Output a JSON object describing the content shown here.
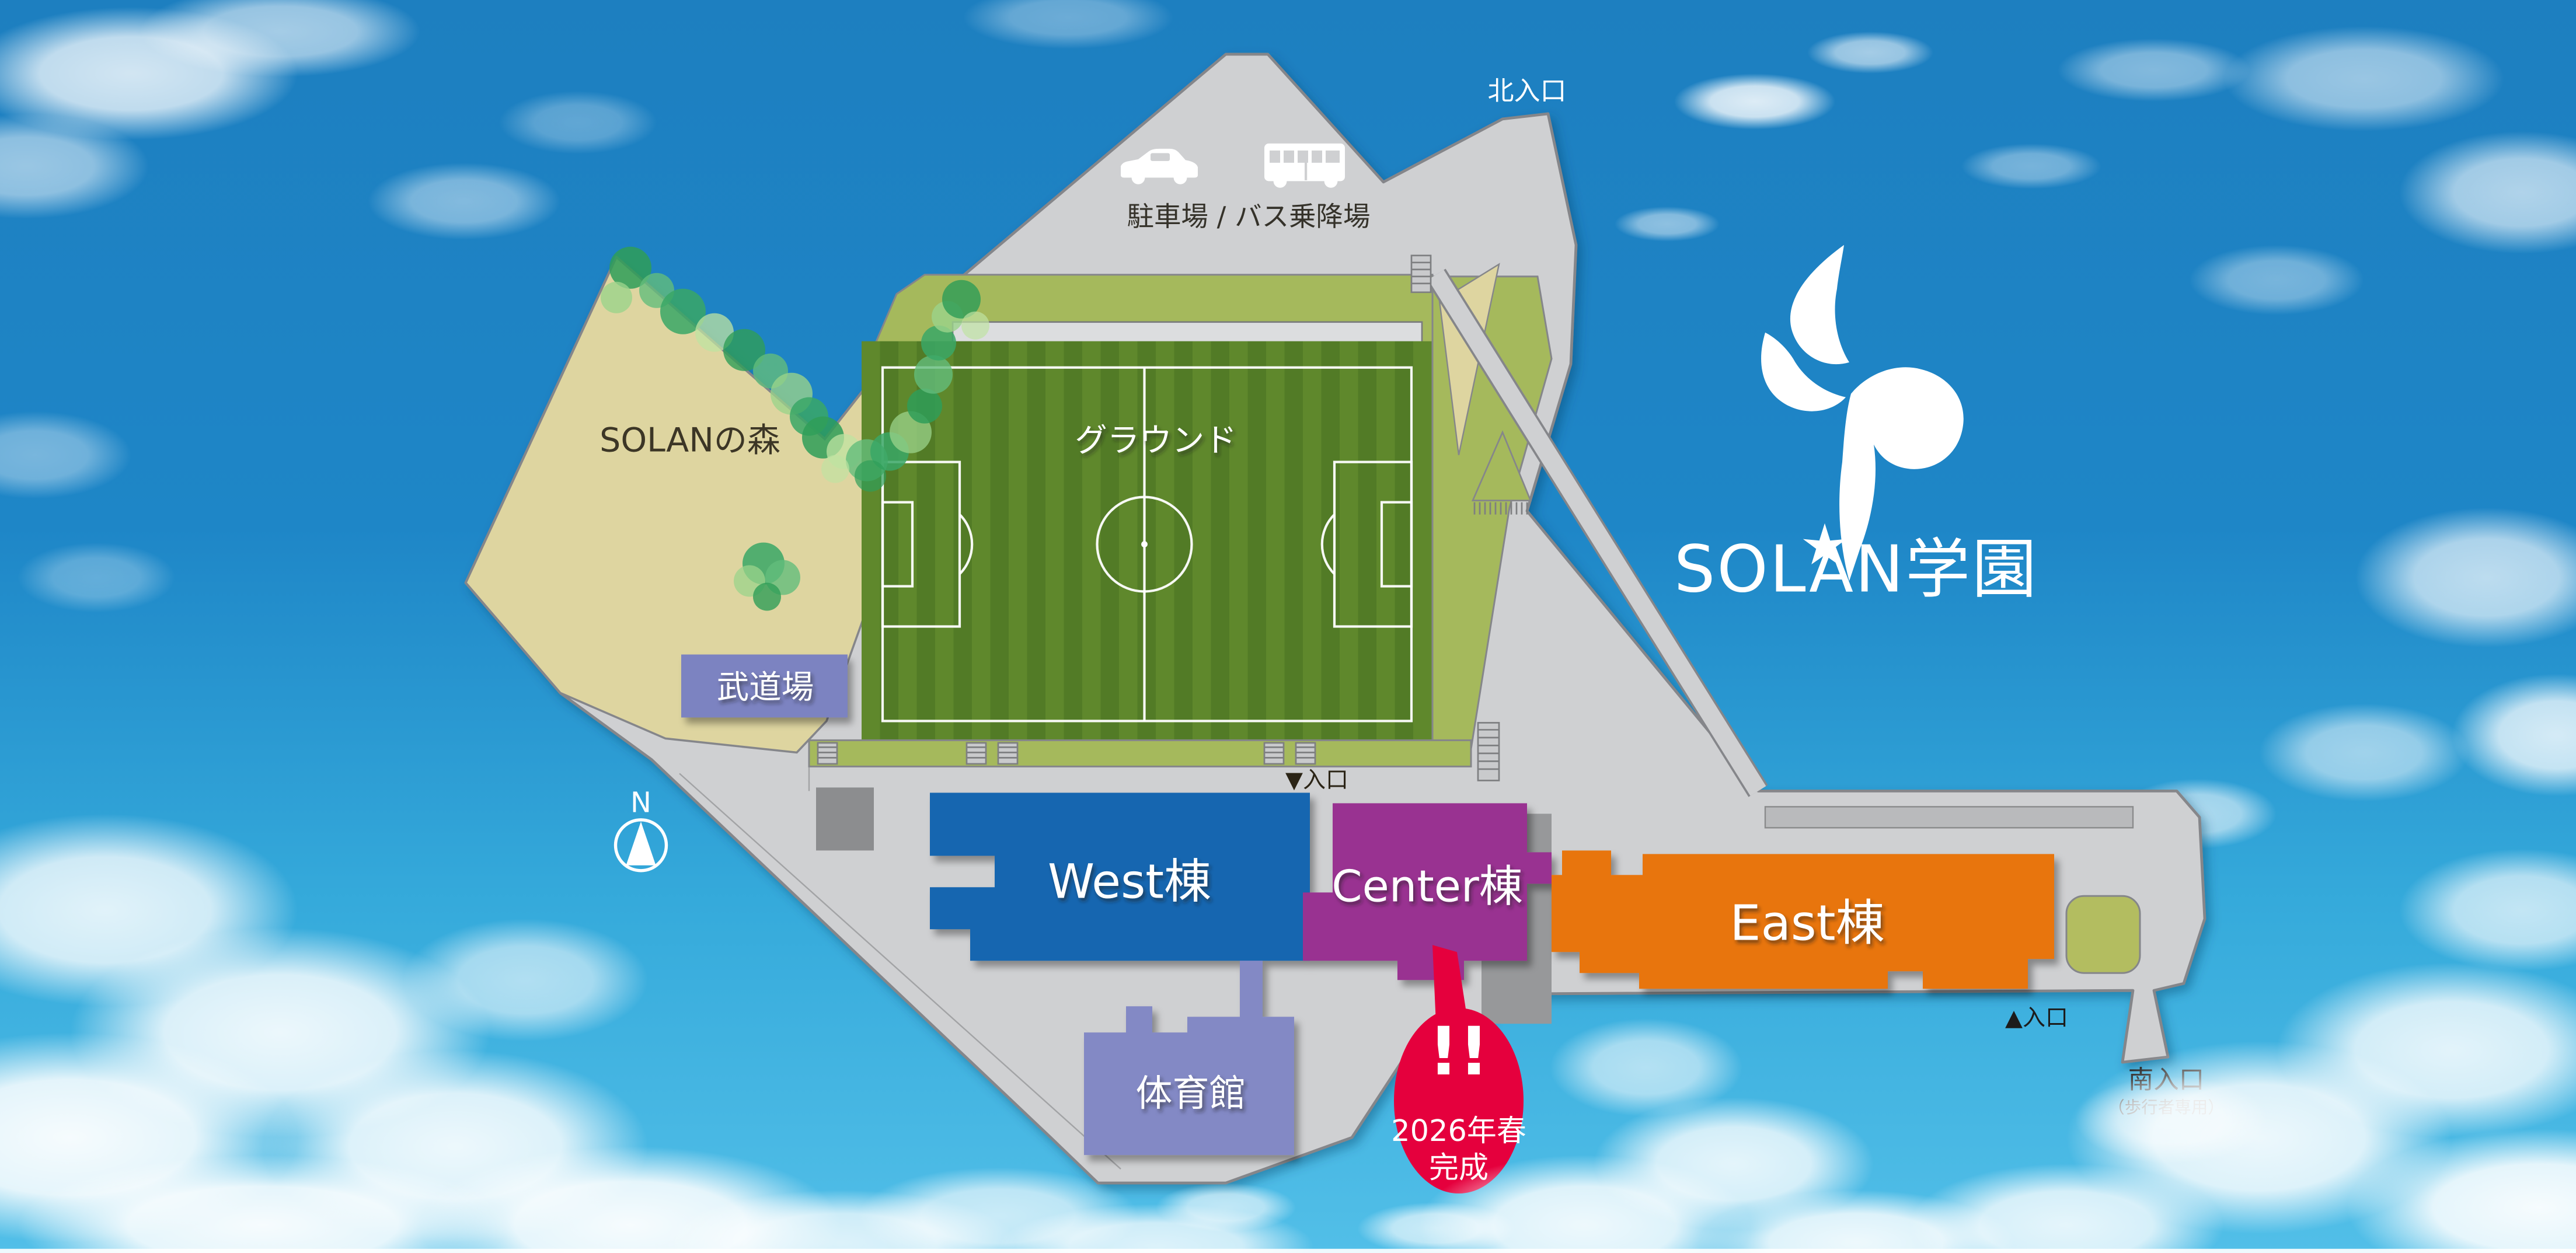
{
  "branding": {
    "school_name": "SOLAN学園"
  },
  "compass": {
    "north_label": "N"
  },
  "entrances": {
    "north": "北入口",
    "field_gate": "▼入口",
    "east_gate": "▲入口",
    "south": "南入口",
    "south_note": "（歩行者専用）"
  },
  "areas": {
    "parking_label": "駐車場 / バス乗降場",
    "forest_label": "SOLANの森",
    "ground_label": "グラウンド"
  },
  "buildings": [
    {
      "id": "budojo",
      "label": "武道場",
      "color": "#7c83c1"
    },
    {
      "id": "west",
      "label": "West棟",
      "color": "#1566b0"
    },
    {
      "id": "center",
      "label": "Center棟",
      "color": "#993191"
    },
    {
      "id": "east",
      "label": "East棟",
      "color": "#e87411"
    },
    {
      "id": "gym",
      "label": "体育館",
      "color": "#8389c5"
    }
  ],
  "announcement": {
    "mark": "!!",
    "line1": "2026年春",
    "line2": "完成",
    "bubble_color": "#e5003d"
  },
  "palette": {
    "sky_top": "#1d7fc0",
    "sky_bottom": "#52bfe8",
    "campus_gray": "#cfd0d2",
    "outline_gray": "#85868a",
    "field_stripe_dark": "#527b26",
    "field_stripe_light": "#5f882c",
    "walkway_green": "#a5b95c",
    "forest_sand": "#ded5a0",
    "lawn_oval": "#b3bd60",
    "logo_white": "#ffffff"
  }
}
